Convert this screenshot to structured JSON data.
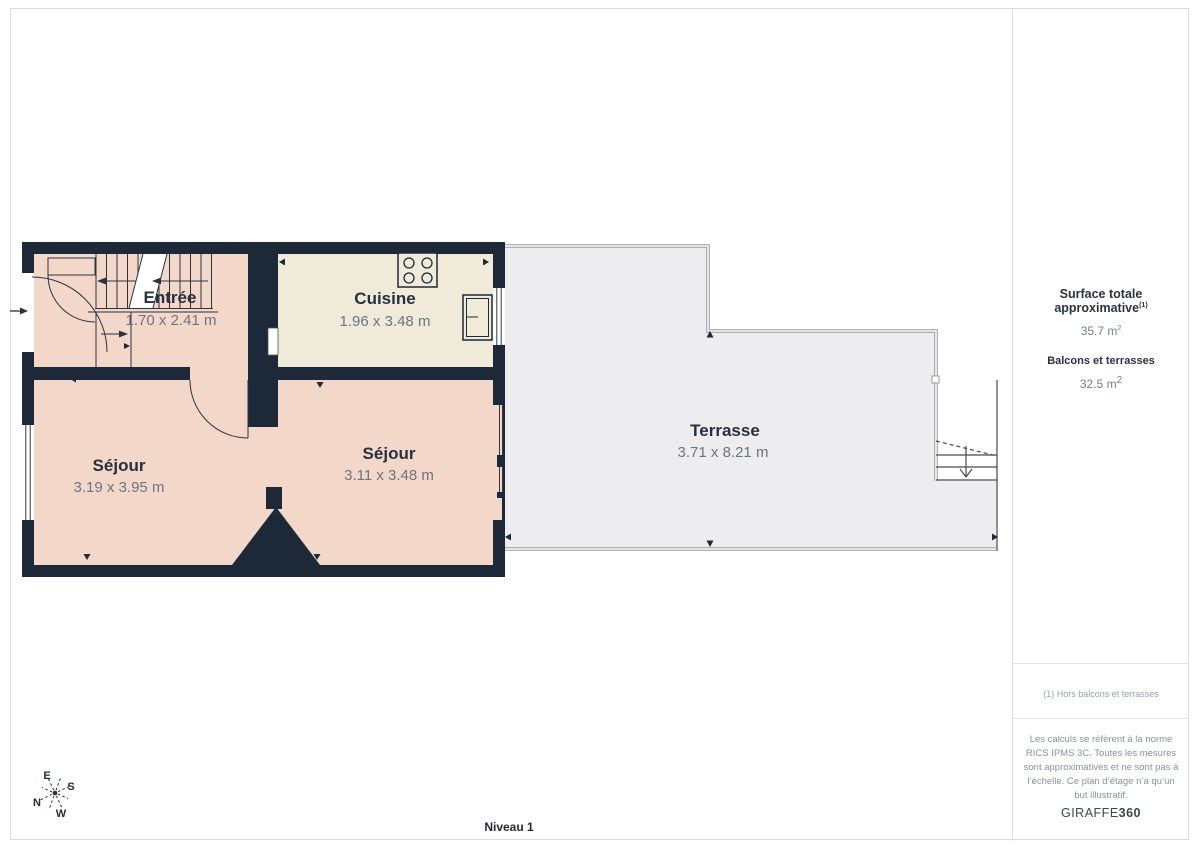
{
  "level_label": "Niveau 1",
  "rooms": [
    {
      "name": "Entrée",
      "dims": "1.70 x 2.41 m"
    },
    {
      "name": "Cuisine",
      "dims": "1.96 x 3.48 m"
    },
    {
      "name": "Séjour",
      "dims": "3.19 x 3.95 m"
    },
    {
      "name": "Séjour",
      "dims": "3.11 x 3.48 m"
    },
    {
      "name": "Terrasse",
      "dims": "3.71 x 8.21 m"
    }
  ],
  "sidebar": {
    "surface_label": "Surface totale approximative",
    "surface_sup": "(1)",
    "surface_value": "35.7 m",
    "surface_value_sup": "2",
    "balconies_label": "Balcons et terrasses",
    "balconies_value": "32.5 m",
    "balconies_value_sup": "2",
    "footnote": "(1) Hors balcons et terrasses",
    "disclaimer": "Les calculs se réfèrent à la norme RICS IPMS 3C. Toutes les mesures sont approximatives et ne sont pas à l’échelle. Ce plan d’étage n’a qu’un but illustratif.",
    "brand_prefix": "GIRAFFE",
    "brand_suffix": "360"
  },
  "compass": {
    "e": "E",
    "s": "S",
    "n": "N",
    "w": "W"
  },
  "colors": {
    "wall": "#1d2939",
    "floor_pink": "#f3d8ca",
    "floor_cream": "#f0ebd9",
    "terrace_fill": "#ededef",
    "terrace_border": "#9b9ba0"
  }
}
